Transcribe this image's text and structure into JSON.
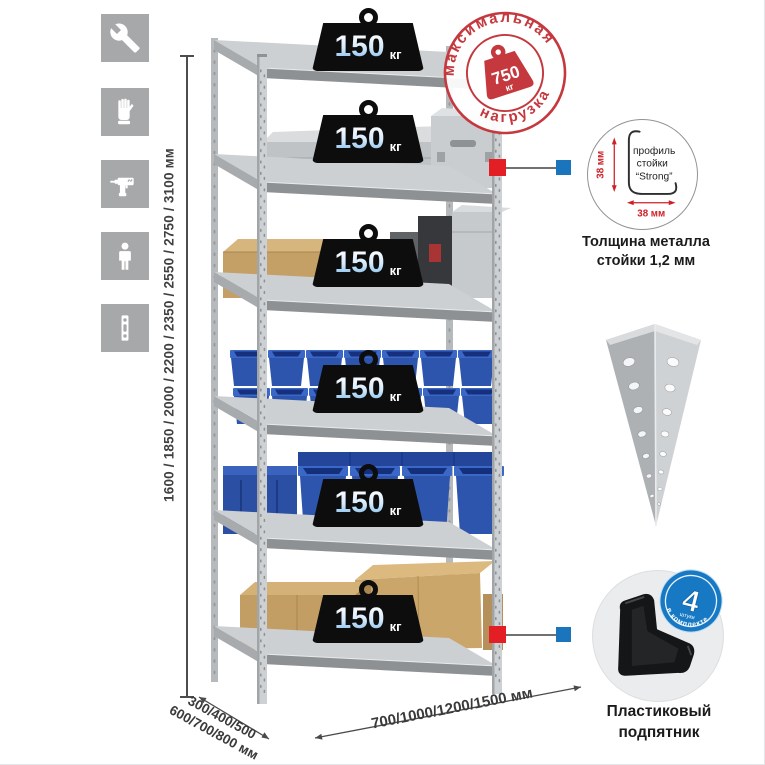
{
  "colors": {
    "accent_red": "#c4383e",
    "marker_red": "#e31e24",
    "marker_blue": "#1b75bc",
    "kit_badge_blue": "#1779c4",
    "bin_blue": "#2e55ad",
    "icon_tile_gray": "#a6a8aa"
  },
  "left_toolbar": {
    "icons": [
      {
        "name": "wrench-icon"
      },
      {
        "name": "gloves-icon"
      },
      {
        "name": "drill-icon"
      },
      {
        "name": "person-icon"
      },
      {
        "name": "rack-post-icon"
      }
    ]
  },
  "height_label": "1600 / 1850 / 2000 / 2200 / 2350 / 2550 / 2750 / 3100 мм",
  "shelf_badges": [
    {
      "value": "150",
      "unit": "кг"
    },
    {
      "value": "150",
      "unit": "кг"
    },
    {
      "value": "150",
      "unit": "кг"
    },
    {
      "value": "150",
      "unit": "кг"
    },
    {
      "value": "150",
      "unit": "кг"
    },
    {
      "value": "150",
      "unit": "кг"
    }
  ],
  "stamp": {
    "arc_top": "максимальная",
    "arc_bottom": "нагрузка",
    "value": "750",
    "unit": "кг"
  },
  "profile_detail": {
    "dim_side": "38 мм",
    "dim_bottom": "38 мм",
    "line1": "профиль",
    "line2": "стойки",
    "line3": "“Strong”",
    "caption_line1": "Толщина металла",
    "caption_line2": "стойки 1,2 мм"
  },
  "foot_detail": {
    "badge_number": "4",
    "badge_sub": "штуки",
    "badge_arc": "в комплекте",
    "caption_line1": "Пластиковый",
    "caption_line2": "подпятник"
  },
  "depth_label": {
    "line1": "300/400/500",
    "line2": "600/700/800 мм"
  },
  "width_label": "700/1000/1200/1500 мм"
}
